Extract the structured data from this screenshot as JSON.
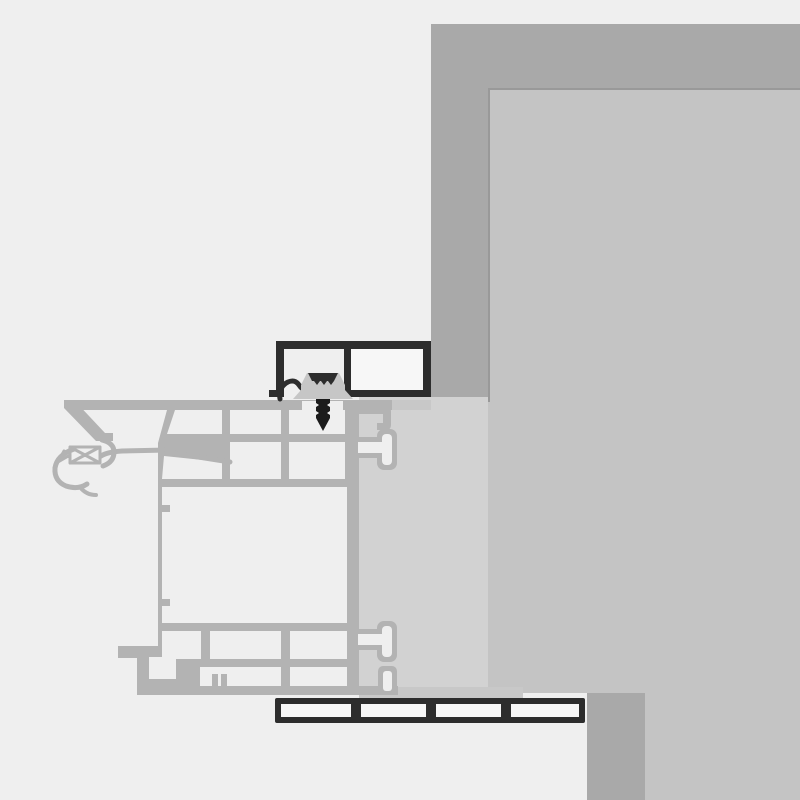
{
  "diagram": {
    "kind": "window-installation-cross-section",
    "text_labels": []
  },
  "colors": {
    "background": "#efefef",
    "wall_outer": "#a9a9a9",
    "wall_inner": "#c4c4c4",
    "wall_inner_border": "#999999",
    "reveal_strip": "#d2d2d2",
    "sub_sill_shelf": "#c8c8c8",
    "profile": "#b3b3b3",
    "profile_cell": "#efefef",
    "dark_outline": "#2d2d2d",
    "dark_cell": "#f7f7f7",
    "clip": "#c6c6c6",
    "screw": "#1b1b1b"
  }
}
